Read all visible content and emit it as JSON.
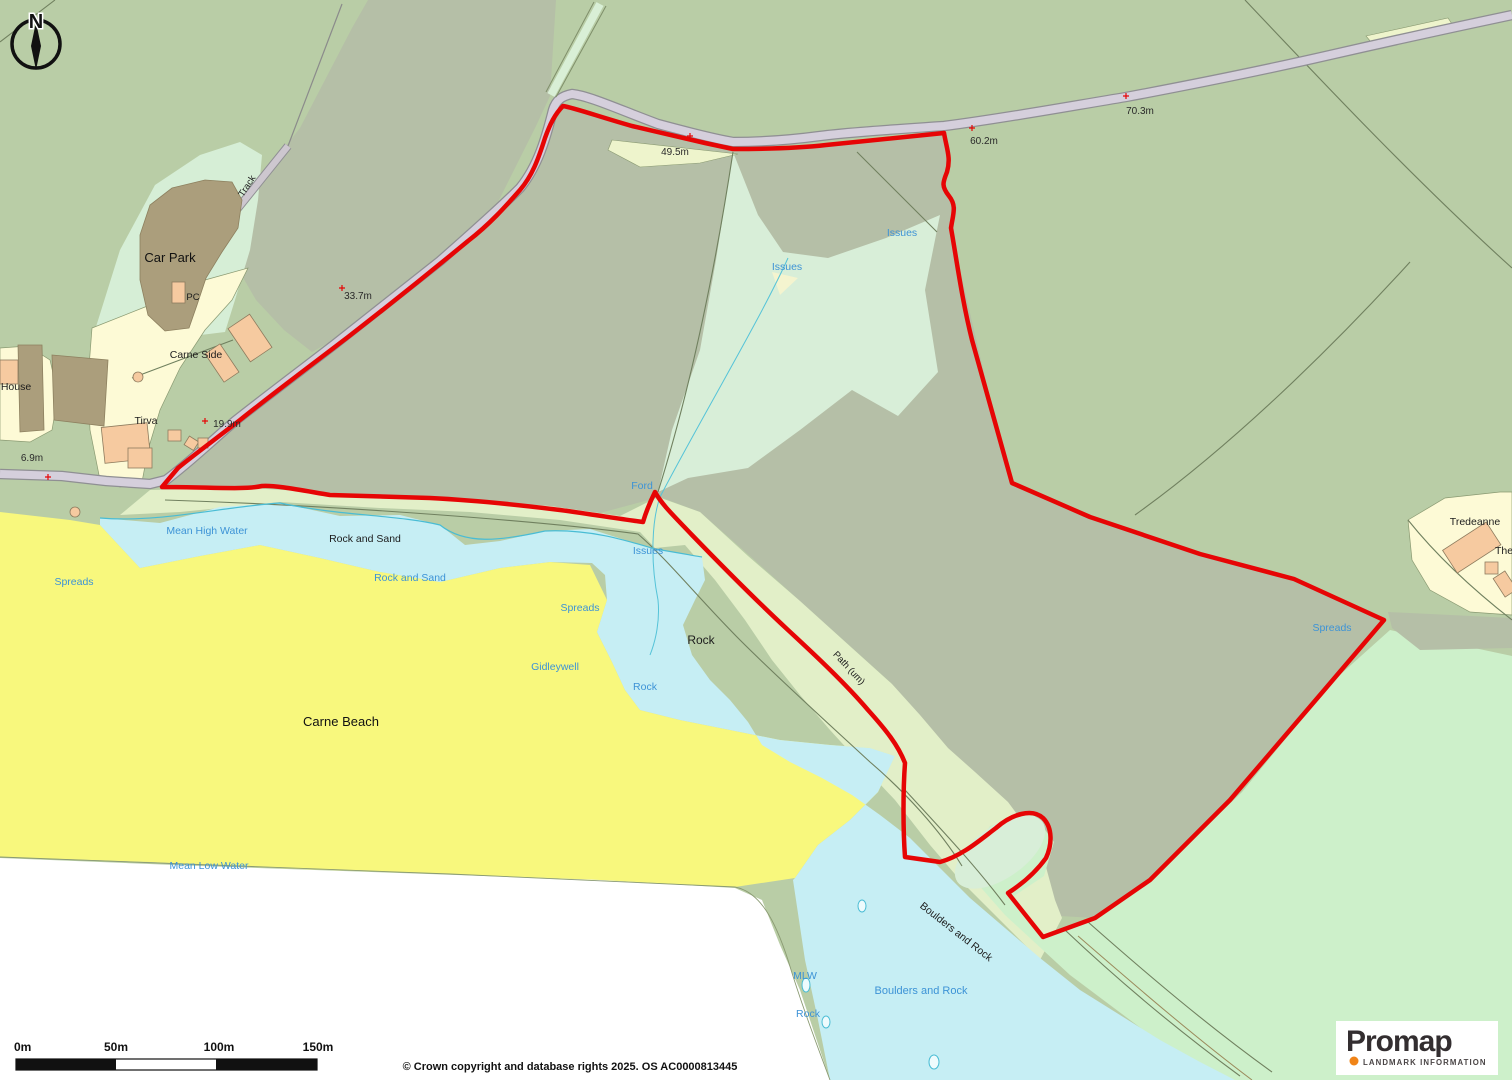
{
  "map": {
    "north_letter": "N",
    "labels": [
      {
        "id": "car-park",
        "text": "Car Park"
      },
      {
        "id": "pc",
        "text": "PC"
      },
      {
        "id": "carne-side",
        "text": "Carne Side"
      },
      {
        "id": "tirva",
        "text": "Tirva"
      },
      {
        "id": "house",
        "text": "House"
      },
      {
        "id": "track",
        "text": "Track"
      },
      {
        "id": "rock-and-sand-black",
        "text": "Rock and Sand"
      },
      {
        "id": "carne-beach",
        "text": "Carne Beach"
      },
      {
        "id": "rock-black",
        "text": "Rock"
      },
      {
        "id": "tredeanne",
        "text": "Tredeanne"
      },
      {
        "id": "the",
        "text": "The"
      },
      {
        "id": "boulders-and-rock-black",
        "text": "Boulders and Rock"
      },
      {
        "id": "path-um",
        "text": "Path (um)"
      },
      {
        "id": "mean-high-water",
        "text": "Mean High Water"
      },
      {
        "id": "rock-and-sand-blue",
        "text": "Rock and Sand"
      },
      {
        "id": "spreads-west",
        "text": "Spreads"
      },
      {
        "id": "spreads-mid",
        "text": "Spreads"
      },
      {
        "id": "gidleywell",
        "text": "Gidleywell"
      },
      {
        "id": "rock-blue-mid",
        "text": "Rock"
      },
      {
        "id": "issues-mid",
        "text": "Issues"
      },
      {
        "id": "ford",
        "text": "Ford"
      },
      {
        "id": "issues-left",
        "text": "Issues"
      },
      {
        "id": "issues-right",
        "text": "Issues"
      },
      {
        "id": "mean-low-water",
        "text": "Mean Low Water"
      },
      {
        "id": "mlw",
        "text": "MLW"
      },
      {
        "id": "rock-blue-south",
        "text": "Rock"
      },
      {
        "id": "boulders-and-rock-blue",
        "text": "Boulders and Rock"
      },
      {
        "id": "spreads-east",
        "text": "Spreads"
      }
    ],
    "elevations": [
      {
        "text": "49.5m"
      },
      {
        "text": "60.2m"
      },
      {
        "text": "70.3m"
      },
      {
        "text": "33.7m"
      },
      {
        "text": "19.9m"
      },
      {
        "text": "6.9m"
      }
    ],
    "scale_bar": {
      "ticks": [
        "0m",
        "50m",
        "100m",
        "150m"
      ],
      "segment_meters": 50
    },
    "attribution": "© Crown copyright and database rights 2025. OS AC0000813445",
    "logo": {
      "name": "Promap",
      "tagline": "LANDMARK INFORMATION"
    },
    "colors": {
      "field_green": "#b9cda6",
      "rough_green": "#b5bfa7",
      "mint": "#d8eed8",
      "coast_band": "#e2efc8",
      "se_mint": "#cdf0ca",
      "parcel_yellow": "#fdfad6",
      "beach_yellow": "#f8f87d",
      "tidal_cyan": "#c6eef4",
      "sea_white": "#ffffff",
      "road_fill": "#d5cfdc",
      "carpark_brown": "#ab9e7c",
      "building_peach": "#f6caa0",
      "boundary_red": "#e60505",
      "water_label_blue": "#3d93d6",
      "logo_orange": "#f08418"
    }
  }
}
